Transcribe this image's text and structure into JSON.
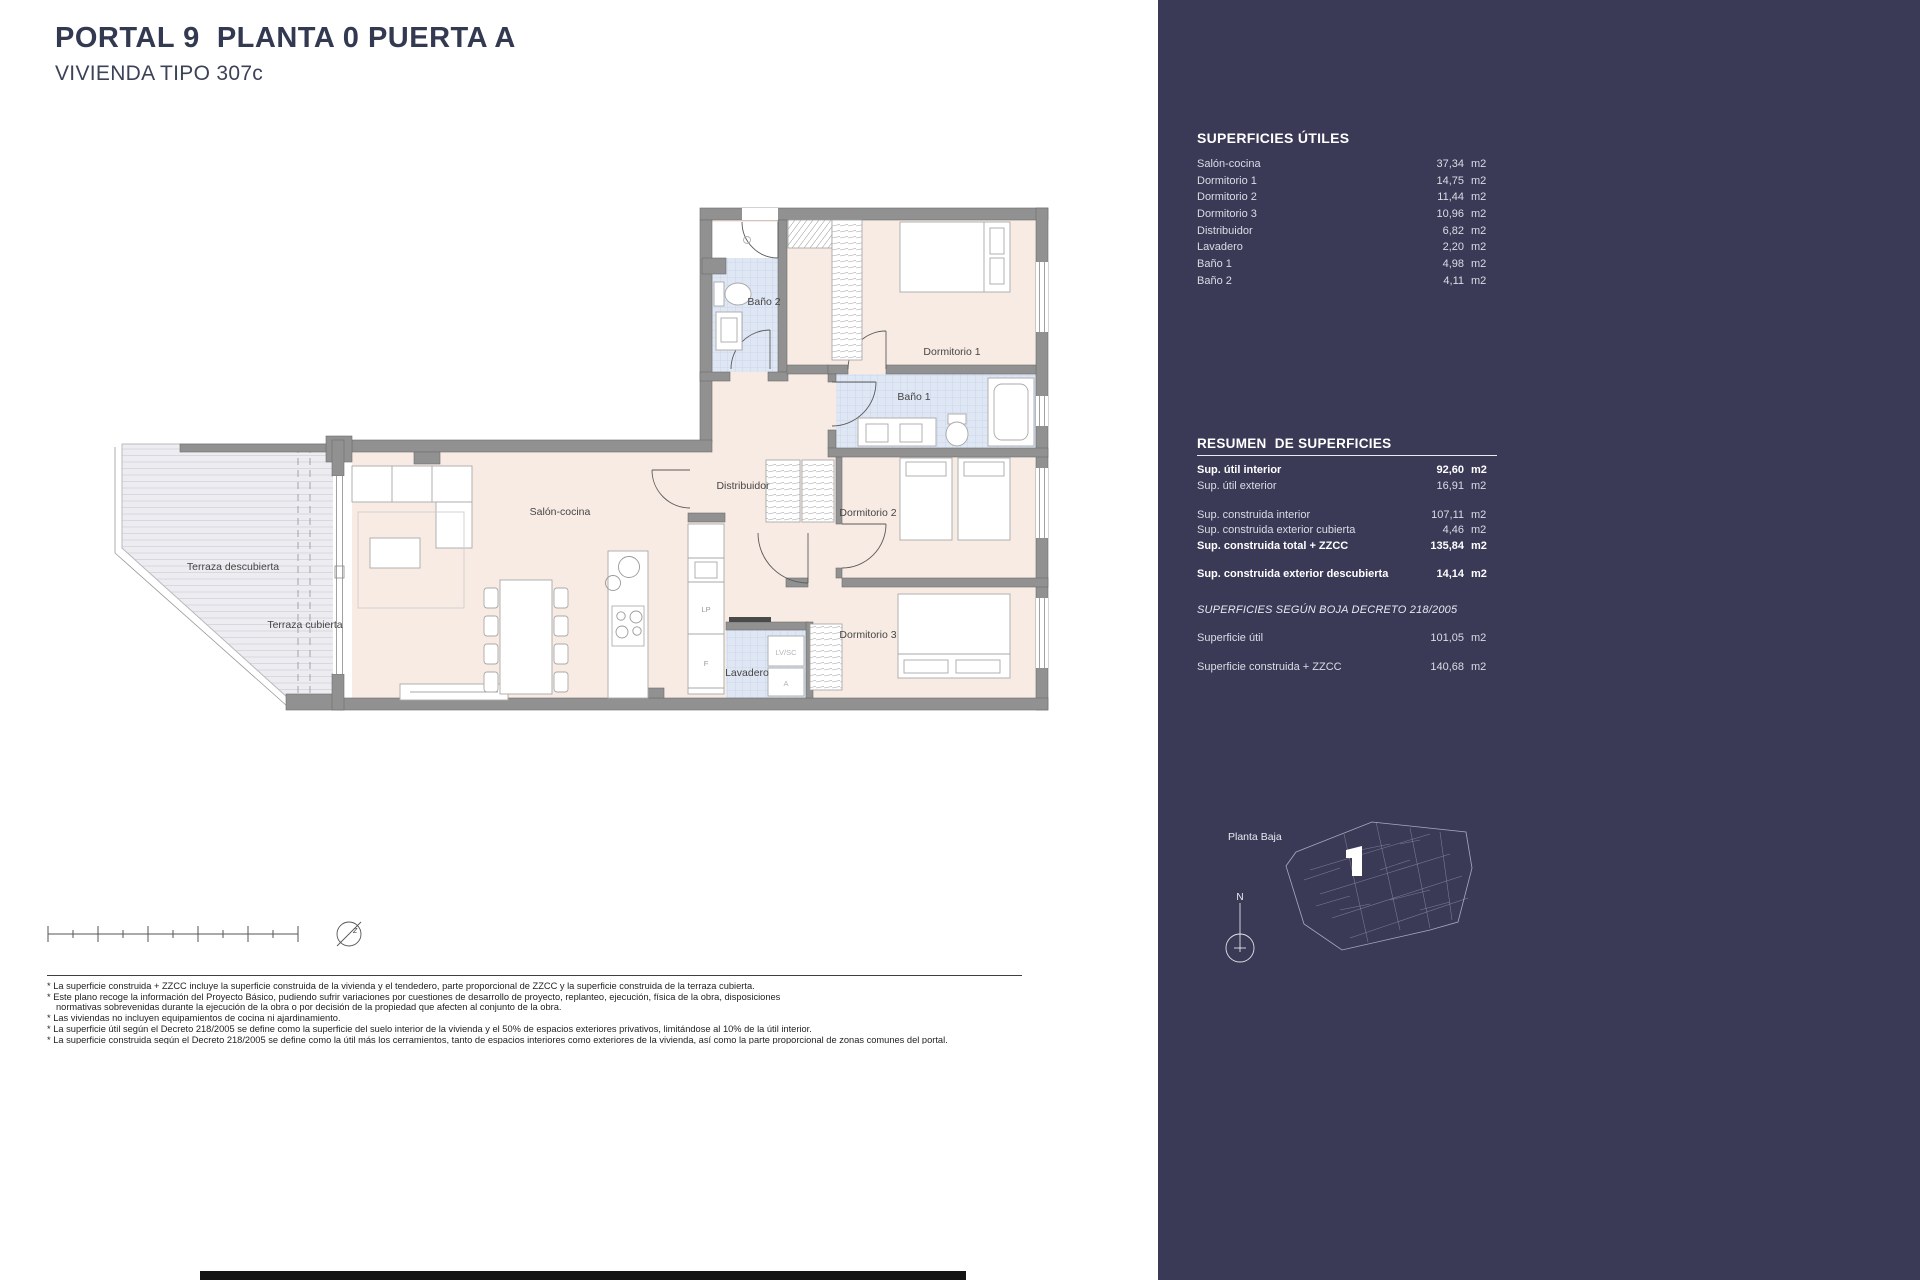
{
  "header": {
    "title": "PORTAL 9  PLANTA 0 PUERTA A",
    "subtitle": "VIVIENDA TIPO 307c"
  },
  "plan": {
    "labels": {
      "terraza_descubierta": "Terraza descubierta",
      "terraza_cubierta": "Terraza cubierta",
      "salon": "Salón-cocina",
      "distribuidor": "Distribuidor",
      "bano2": "Baño 2",
      "dormitorio1": "Dormitorio 1",
      "bano1": "Baño 1",
      "dormitorio2": "Dormitorio 2",
      "dormitorio3": "Dormitorio 3",
      "lavadero": "Lavadero",
      "lp": "LP",
      "f": "F",
      "lvsc": "LV/SC",
      "a": "A",
      "north_z": "z"
    }
  },
  "sidebar": {
    "bg_color": "#3a3a57",
    "superficies_utiles": {
      "title": "SUPERFICIES ÚTILES",
      "rows": [
        {
          "label": "Salón-cocina",
          "value": "37,34",
          "unit": "m2"
        },
        {
          "label": "Dormitorio 1",
          "value": "14,75",
          "unit": "m2"
        },
        {
          "label": "Dormitorio 2",
          "value": "11,44",
          "unit": "m2"
        },
        {
          "label": "Dormitorio 3",
          "value": "10,96",
          "unit": "m2"
        },
        {
          "label": "Distribuidor",
          "value": "6,82",
          "unit": "m2"
        },
        {
          "label": "Lavadero",
          "value": "2,20",
          "unit": "m2"
        },
        {
          "label": "Baño 1",
          "value": "4,98",
          "unit": "m2"
        },
        {
          "label": "Baño 2",
          "value": "4,11",
          "unit": "m2"
        }
      ]
    },
    "resumen": {
      "title": "RESUMEN  DE SUPERFICIES",
      "rows": [
        {
          "label": "Sup. útil interior",
          "value": "92,60",
          "unit": "m2"
        },
        {
          "label": "Sup. útil exterior",
          "value": "16,91",
          "unit": "m2"
        },
        {
          "label": "Sup. construida interior",
          "value": "107,11",
          "unit": "m2"
        },
        {
          "label": "Sup. construida exterior cubierta",
          "value": "4,46",
          "unit": "m2"
        },
        {
          "label": "Sup. construida total + ZZCC",
          "value": "135,84",
          "unit": "m2"
        },
        {
          "label": "Sup. construida exterior descubierta",
          "value": "14,14",
          "unit": "m2"
        }
      ]
    },
    "boja": {
      "title": "SUPERFICIES SEGÚN BOJA DECRETO 218/2005",
      "rows": [
        {
          "label": "Superficie útil",
          "value": "101,05",
          "unit": "m2"
        },
        {
          "label": "Superficie construida + ZZCC",
          "value": "140,68",
          "unit": "m2"
        }
      ]
    },
    "key_plan": {
      "label": "Planta Baja",
      "compass_letter": "N"
    }
  },
  "footnotes": [
    "* La superficie construida + ZZCC incluye la superficie construida de la vivienda y el tendedero, parte proporcional de ZZCC y la superficie construida de la terraza cubierta.",
    "* Este plano recoge la información del Proyecto Básico, pudiendo sufrir variaciones por cuestiones de desarrollo de proyecto, replanteo, ejecución, física de la obra, disposiciones",
    "normativas sobrevenidas durante la ejecución de la obra o por decisión de la propiedad que afecten al conjunto de la obra.",
    "* Las viviendas no incluyen equipamientos de cocina ni ajardinamiento.",
    "* La superficie útil según el Decreto 218/2005 se define como la superficie del suelo interior de la vivienda y el 50% de espacios exteriores privativos, limitándose al 10% de la útil interior.",
    "* La superficie construida según el Decreto 218/2005 se define como la útil más los cerramientos, tanto de espacios interiores como exteriores de la vivienda, así como la parte proporcional de zonas comunes del portal."
  ]
}
